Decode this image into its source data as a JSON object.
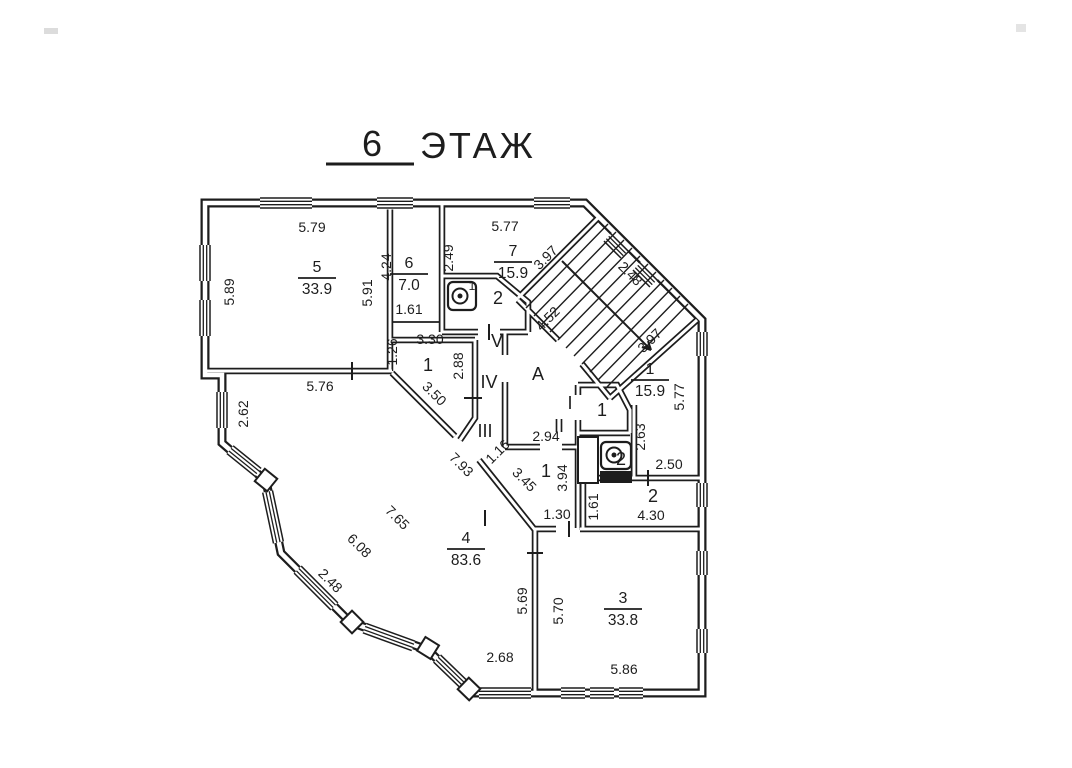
{
  "title": {
    "number": "6",
    "word": "ЭТАЖ"
  },
  "colors": {
    "ink": "#1d1d1d",
    "paper": "#ffffff"
  },
  "plan": {
    "dimensions": [
      {
        "t": "5.79",
        "x": 312,
        "y": 232,
        "r": 0
      },
      {
        "t": "5.89",
        "x": 234,
        "y": 292,
        "r": -90
      },
      {
        "t": "5.91",
        "x": 372,
        "y": 293,
        "r": -90
      },
      {
        "t": "4.24",
        "x": 391,
        "y": 267,
        "r": -90
      },
      {
        "t": "1.61",
        "x": 409,
        "y": 314,
        "r": 0
      },
      {
        "t": "2.49",
        "x": 453,
        "y": 258,
        "r": -90
      },
      {
        "t": "5.77",
        "x": 505,
        "y": 231,
        "r": 0
      },
      {
        "t": "3.97",
        "x": 549,
        "y": 261,
        "r": -45
      },
      {
        "t": "2.48",
        "x": 627,
        "y": 277,
        "r": 45
      },
      {
        "t": "4.52",
        "x": 551,
        "y": 322,
        "r": -45
      },
      {
        "t": "3.97",
        "x": 653,
        "y": 344,
        "r": -45
      },
      {
        "t": "5.77",
        "x": 684,
        "y": 397,
        "r": -90
      },
      {
        "t": "2.63",
        "x": 645,
        "y": 437,
        "r": -90
      },
      {
        "t": "2.50",
        "x": 669,
        "y": 469,
        "r": 0
      },
      {
        "t": "4.30",
        "x": 651,
        "y": 520,
        "r": 0
      },
      {
        "t": "1.61",
        "x": 598,
        "y": 507,
        "r": -90
      },
      {
        "t": "2.94",
        "x": 546,
        "y": 441,
        "r": 0
      },
      {
        "t": "3.94",
        "x": 567,
        "y": 478,
        "r": -90
      },
      {
        "t": "1.30",
        "x": 557,
        "y": 519,
        "r": 0
      },
      {
        "t": "1.16",
        "x": 501,
        "y": 455,
        "r": -45
      },
      {
        "t": "3.45",
        "x": 521,
        "y": 483,
        "r": 45
      },
      {
        "t": "7.93",
        "x": 458,
        "y": 468,
        "r": 45
      },
      {
        "t": "3.50",
        "x": 431,
        "y": 397,
        "r": 45
      },
      {
        "t": "2.88",
        "x": 463,
        "y": 366,
        "r": -90
      },
      {
        "t": "3.30",
        "x": 430,
        "y": 344,
        "r": 0
      },
      {
        "t": "1.26",
        "x": 397,
        "y": 352,
        "r": -90
      },
      {
        "t": "5.76",
        "x": 320,
        "y": 391,
        "r": 0
      },
      {
        "t": "2.62",
        "x": 248,
        "y": 414,
        "r": -90
      },
      {
        "t": "7.65",
        "x": 394,
        "y": 521,
        "r": 45
      },
      {
        "t": "6.08",
        "x": 356,
        "y": 549,
        "r": 45
      },
      {
        "t": "2.48",
        "x": 327,
        "y": 584,
        "r": 45
      },
      {
        "t": "2.68",
        "x": 500,
        "y": 662,
        "r": 0
      },
      {
        "t": "5.69",
        "x": 527,
        "y": 601,
        "r": -90
      },
      {
        "t": "5.70",
        "x": 563,
        "y": 611,
        "r": -90
      },
      {
        "t": "5.86",
        "x": 624,
        "y": 674,
        "r": 0
      }
    ],
    "room_labels": [
      {
        "t": "2",
        "x": 498,
        "y": 304
      },
      {
        "t": "V",
        "x": 497,
        "y": 347
      },
      {
        "t": "A",
        "x": 538,
        "y": 380
      },
      {
        "t": "IV",
        "x": 489,
        "y": 388
      },
      {
        "t": "III",
        "x": 485,
        "y": 437
      },
      {
        "t": "II",
        "x": 559,
        "y": 432
      },
      {
        "t": "I",
        "x": 570,
        "y": 409
      },
      {
        "t": "1",
        "x": 428,
        "y": 371
      },
      {
        "t": "1",
        "x": 602,
        "y": 416
      },
      {
        "t": "2",
        "x": 621,
        "y": 465
      },
      {
        "t": "1",
        "x": 546,
        "y": 477
      },
      {
        "t": "2",
        "x": 653,
        "y": 502
      },
      {
        "t": "1",
        "x": 472,
        "y": 290,
        "small": true
      }
    ],
    "room_fractions": [
      {
        "num": "5",
        "area": "33.9",
        "x": 317,
        "y": 272
      },
      {
        "num": "6",
        "area": "7.0",
        "x": 409,
        "y": 268
      },
      {
        "num": "7",
        "area": "15.9",
        "x": 513,
        "y": 256
      },
      {
        "num": "1",
        "area": "15.9",
        "x": 650,
        "y": 374
      },
      {
        "num": "4",
        "area": "83.6",
        "x": 466,
        "y": 543
      },
      {
        "num": "3",
        "area": "33.8",
        "x": 623,
        "y": 603
      }
    ]
  }
}
